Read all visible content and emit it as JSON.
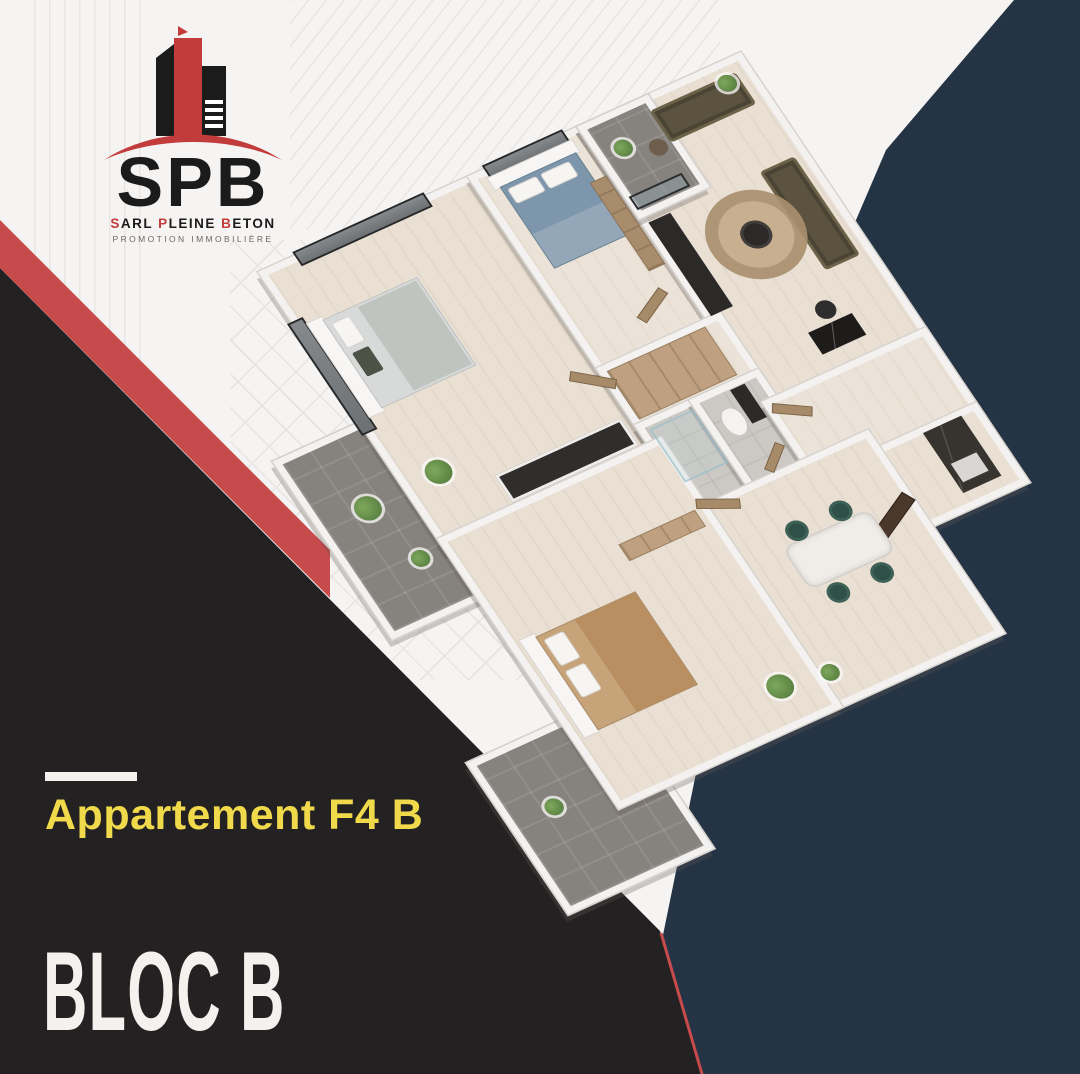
{
  "brand": {
    "name": "SPB",
    "tagline_parts": [
      "S",
      "ARL ",
      "P",
      "LEINE ",
      "B",
      "ETON"
    ],
    "subtitle": "PROMOTION IMMOBILIÈRE"
  },
  "labels": {
    "apartment_title": "Appartement F4 B",
    "block_title": "BLOC B"
  },
  "colors": {
    "canvas": "#f6f4f3",
    "navy": "#253444",
    "charcoal": "#232122",
    "accent-red": "#c74a4c",
    "title-yellow": "#f0d94a",
    "logo-red": "#c23c3c",
    "logo-ink": "#1c1b1b",
    "text-white": "#f4f2ef",
    "sketch-line": "#dcd9d6"
  }
}
